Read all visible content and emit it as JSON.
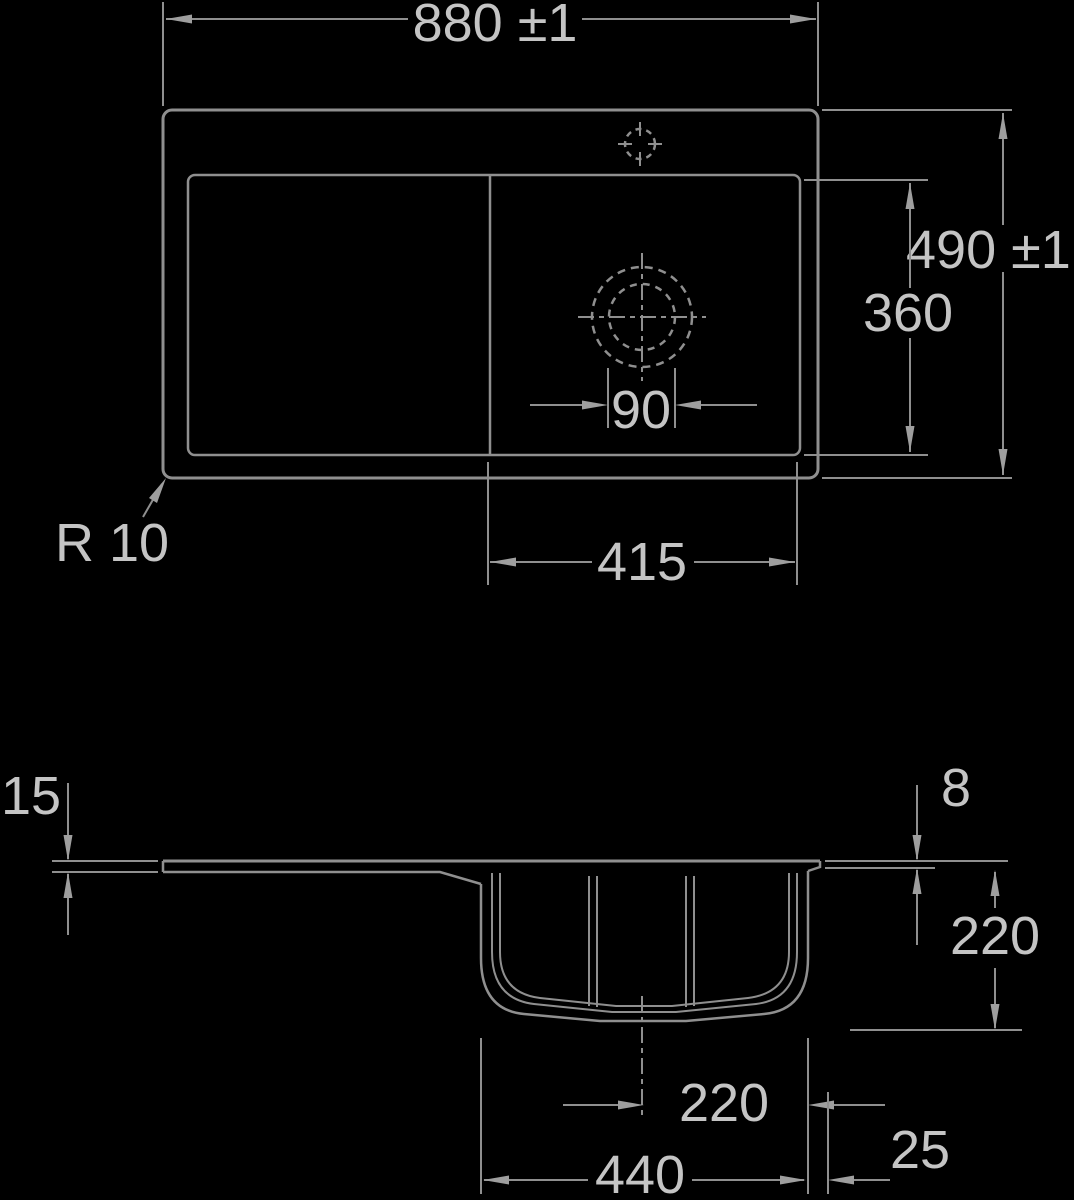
{
  "drawing": {
    "type": "technical-dimension-drawing",
    "subject": "kitchen sink with drainboard, plan view and section view",
    "background_color": "#000000",
    "line_color": "#8f8f8f",
    "text_color": "#c4c4c4",
    "dimensions": {
      "overall_width": "880 ±1",
      "overall_depth": "490 ±1",
      "basin_depth_plan": "360",
      "basin_width_plan": "415",
      "drain_diameter": "90",
      "corner_radius": "R 10",
      "rim_height_left": "15",
      "rim_height_right": "8",
      "bowl_depth_section": "220",
      "drain_center_offset": "220",
      "bowl_width_section": "440",
      "edge_offset": "25"
    }
  }
}
